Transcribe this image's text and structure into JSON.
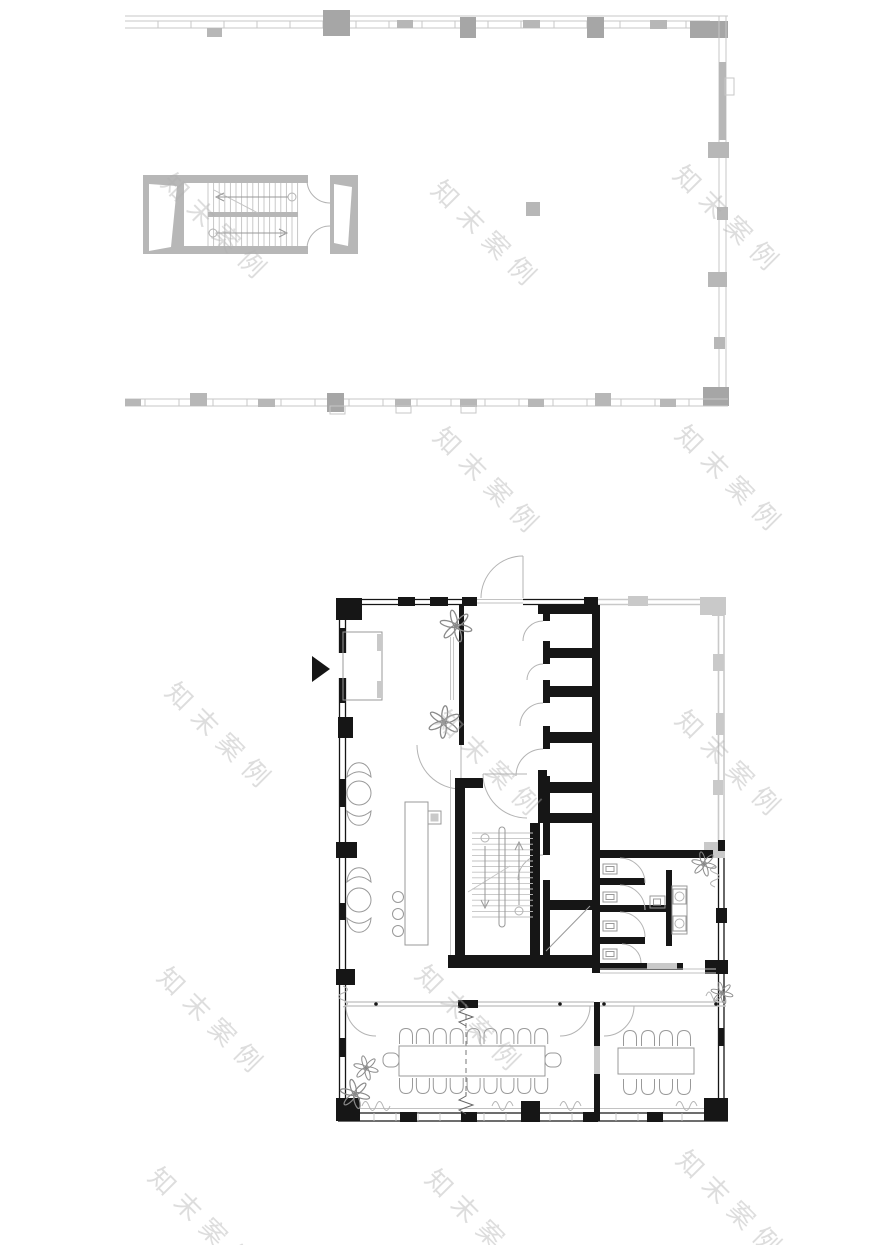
{
  "document": {
    "type": "architectural-floor-plan-sheet",
    "plans": [
      "upper-level-shell-plan",
      "main-level-plan"
    ]
  },
  "watermark": {
    "text": "知末案例",
    "font_size": 26,
    "letter_spacing": 10,
    "rotation_deg": 45,
    "positions": [
      [
        218,
        228
      ],
      [
        488,
        235
      ],
      [
        730,
        220
      ],
      [
        490,
        482
      ],
      [
        732,
        480
      ],
      [
        222,
        737
      ],
      [
        492,
        765
      ],
      [
        732,
        765
      ],
      [
        214,
        1022
      ],
      [
        472,
        1020
      ],
      [
        205,
        1222
      ],
      [
        482,
        1224
      ],
      [
        733,
        1205
      ]
    ]
  },
  "colors": {
    "background": "#ffffff",
    "upper_line": "#c7c7c7",
    "upper_fill": "#b7b7b7",
    "upper_dark": "#a6a6a6",
    "wall_black": "#161616",
    "glass_gray": "#c9c9c9",
    "furniture": "#999999",
    "door_arc": "#b3b3b3",
    "tread": "#c2c2c2",
    "watermark": "rgba(175,175,175,0.42)"
  },
  "generated": {
    "upper_stair_treads": {
      "x_start": 208,
      "step": 5.6,
      "count": 17,
      "y1": 183,
      "y2": 246
    },
    "lower_stair_treads": {
      "y_start": 833,
      "step": 5.6,
      "count": 16,
      "x1": 472,
      "x2": 533
    },
    "ticks_top": {
      "x_start": 158,
      "step": 33,
      "count": 17,
      "y1": 21,
      "y2": 28
    },
    "ticks_bottom": {
      "x_start": 145,
      "step": 34,
      "count": 17,
      "y1": 399,
      "y2": 406
    },
    "ticks_bottom_wall": {
      "x_start": 352,
      "step": 22,
      "count": 16,
      "y1": 1113,
      "y2": 1121
    }
  },
  "furniture": {
    "long_table": {
      "chairs_top": 9,
      "chairs_bottom": 9,
      "chair_step": 16.9,
      "x_start": 406,
      "y_top": 1036,
      "y_bottom": 1086,
      "end_chairs": 2
    },
    "small_table": {
      "chairs_top": 4,
      "chairs_bottom": 4,
      "chair_step": 18,
      "x_start": 630,
      "y_top": 1038,
      "y_bottom": 1087
    },
    "lounge_chairs": 6,
    "bar_stools": 3,
    "reception_desk": 1
  },
  "rooms": {
    "phone_booths": 5,
    "wc_stalls": 4,
    "washbasins": 2,
    "conference_rooms": 2,
    "stair_cores": 2,
    "plants": 6
  }
}
